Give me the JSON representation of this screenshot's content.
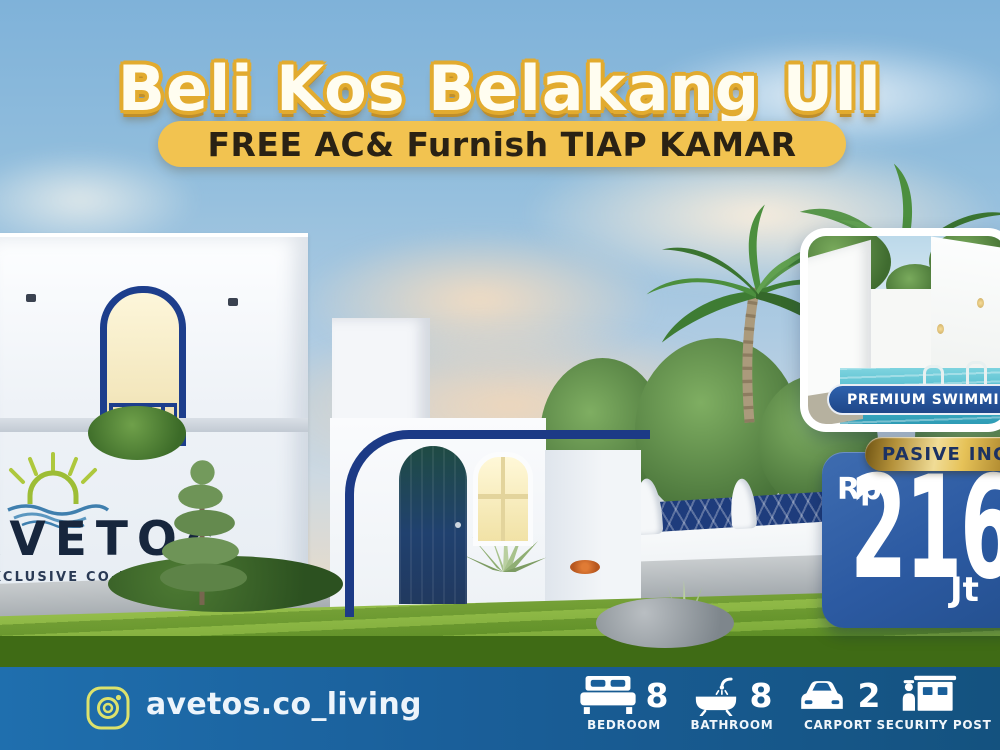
{
  "title": "Beli Kos Belakang UII",
  "subtitle": "FREE AC& Furnish TIAP KAMAR",
  "pool_card": {
    "label": "PREMIUM SWIMMING POOL"
  },
  "income_badge": {
    "label": "PASIVE INCOME"
  },
  "price_card": {
    "currency": "Rp",
    "amount": "216",
    "unit": "Jt"
  },
  "building_sign": {
    "brand": "ΛVETOς",
    "tagline": "EXCLUSIVE CO-LIVING +"
  },
  "footer": {
    "instagram_handle": "avetos.co_living",
    "amenities": [
      {
        "icon": "bed-icon",
        "count": "8",
        "label": "BEDROOM"
      },
      {
        "icon": "bathtub-icon",
        "count": "8",
        "label": "BATHROOM"
      },
      {
        "icon": "car-icon",
        "count": "2",
        "label": "CARPORT"
      },
      {
        "icon": "guard-post-icon",
        "count": "",
        "label": "SECURITY POST"
      }
    ]
  },
  "colors": {
    "accent_navy": "#1d3e8c",
    "title_outline_gold": "#e2ab2f",
    "subtitle_pill_yellow": "#f2c350",
    "footer_blue": "#1a5f9a",
    "price_card_blue": "#2c5aa2",
    "badge_gold": "#e6c258",
    "pool_label_blue": "#2e62ae",
    "lawn_green": "#5c8f24"
  }
}
